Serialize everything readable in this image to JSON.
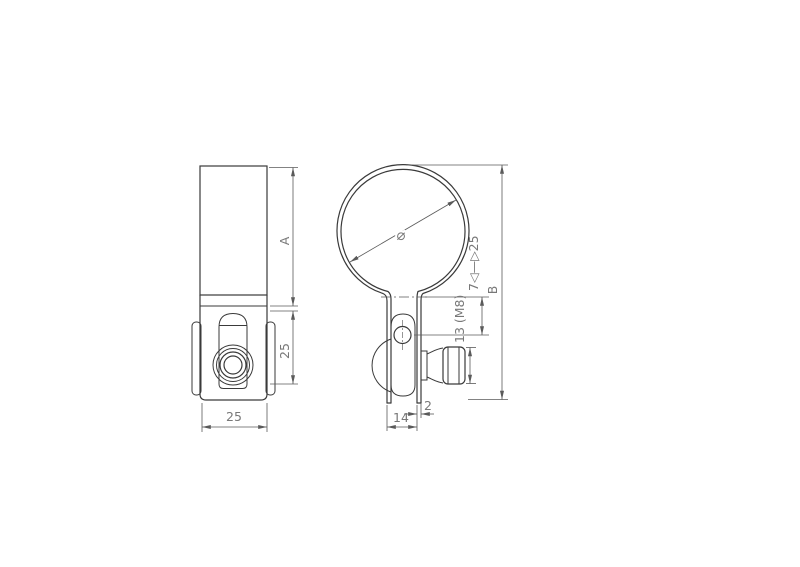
{
  "colors": {
    "background": "#ffffff",
    "outline": "#3a3a3a",
    "dimension_lines": "#5a5a5a",
    "dimension_text": "#787878"
  },
  "dimensions": {
    "front_height": "A",
    "front_lower_height": "25",
    "front_width": "25",
    "diameter_symbol": "⌀",
    "overall_height": "B",
    "clamp_range": "7◁—▷25",
    "nut_size": "13 (M8)",
    "strap_thickness": "2",
    "leg_width": "14"
  }
}
